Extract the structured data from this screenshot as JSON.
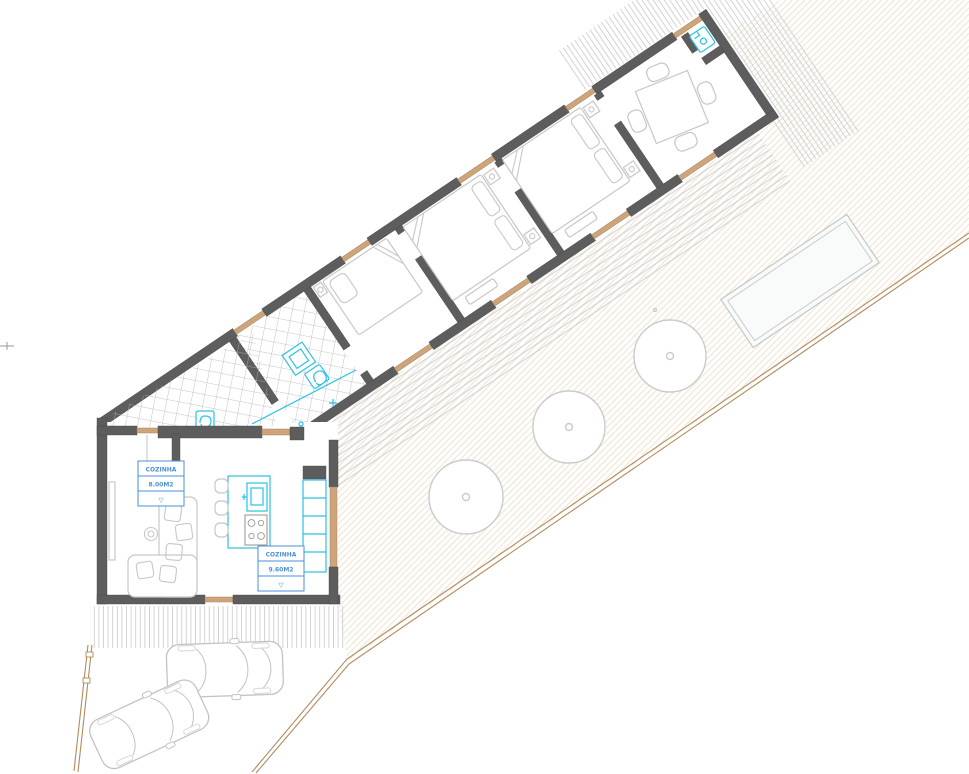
{
  "plan": {
    "labels": {
      "area_label_1": {
        "name": "COZINHA",
        "area": "8.00M2",
        "level_symbol": "▽"
      },
      "area_label_2": {
        "name": "COZINHA",
        "area": "9.60M2",
        "level_symbol": "▽"
      }
    },
    "palette": {
      "wall": "#5d5d5d",
      "threshold_wood": "#cda57c",
      "fixture_cyan": "#29c3e2",
      "label_blue": "#4a90d9",
      "boundary_tan": "#b18a5f",
      "furniture_gray": "#c7c7c7",
      "terrain_hatch": "#e9dcc4"
    },
    "site": {
      "trees": 3,
      "cars": 2,
      "pools": 1
    },
    "rooms": [
      "kitchen-living",
      "bathroom",
      "bedroom-1",
      "bedroom-2",
      "bedroom-3",
      "dining-room"
    ]
  }
}
